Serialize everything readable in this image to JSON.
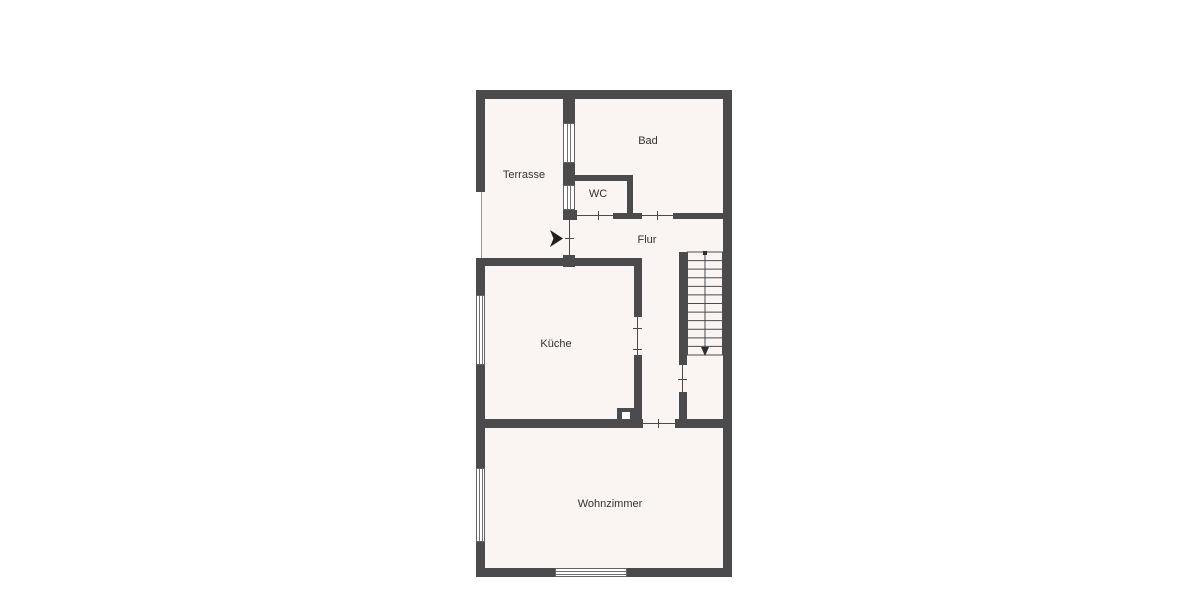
{
  "floorplan": {
    "kind": "residential floor plan",
    "wall_color": "#4b4b4d",
    "floor_color": "#faf4f2",
    "label_color": "#333333",
    "rooms": [
      {
        "id": "terrasse",
        "label": "Terrasse"
      },
      {
        "id": "bad",
        "label": "Bad"
      },
      {
        "id": "wc",
        "label": "WC"
      },
      {
        "id": "flur",
        "label": "Flur"
      },
      {
        "id": "kueche",
        "label": "Küche"
      },
      {
        "id": "wohnzimmer",
        "label": "Wohnzimmer"
      }
    ],
    "stairs": {
      "tread_lines": 13,
      "walk_line_arrow": "down"
    },
    "symbols": {
      "windows": 5,
      "door_openings": 6,
      "entrance_arrow_direction": "right"
    }
  }
}
